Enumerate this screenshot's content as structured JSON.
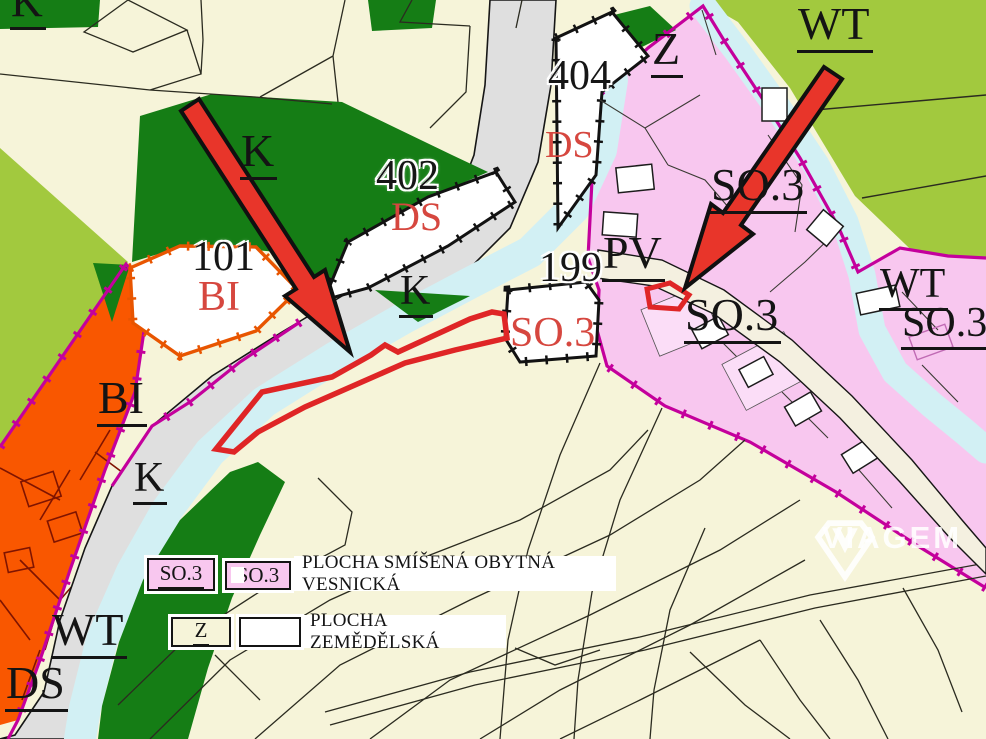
{
  "map": {
    "labels": [
      {
        "text": "K",
        "kind": "zone-clipped-top-left"
      },
      {
        "text": "K",
        "kind": "zone-landscape-green"
      },
      {
        "text": "402",
        "kind": "parcel-number"
      },
      {
        "text": "DS",
        "kind": "zone-road-proposed"
      },
      {
        "text": "404",
        "kind": "parcel-number"
      },
      {
        "text": "DS",
        "kind": "zone-road-proposed"
      },
      {
        "text": "Z",
        "kind": "zone-agricultural"
      },
      {
        "text": "WT",
        "kind": "zone-water"
      },
      {
        "text": "101",
        "kind": "parcel-number"
      },
      {
        "text": "BI",
        "kind": "zone-housing-proposed"
      },
      {
        "text": "K",
        "kind": "zone-landscape-green"
      },
      {
        "text": "199",
        "kind": "parcel-number"
      },
      {
        "text": "PV",
        "kind": "zone-public-space"
      },
      {
        "text": "SO.3",
        "kind": "zone-mixed-residential"
      },
      {
        "text": "SO.3",
        "kind": "zone-mixed-residential-proposed"
      },
      {
        "text": "SO.3",
        "kind": "zone-mixed-residential"
      },
      {
        "text": "WT",
        "kind": "zone-water"
      },
      {
        "text": "SO.3",
        "kind": "zone-mixed-residential"
      },
      {
        "text": "BI",
        "kind": "zone-housing"
      },
      {
        "text": "K",
        "kind": "zone-landscape-green"
      },
      {
        "text": "WT",
        "kind": "zone-water"
      },
      {
        "text": "DS",
        "kind": "zone-road"
      }
    ]
  },
  "legend": {
    "row1": {
      "box1_label": "SO.3",
      "box2_label": "SO.3",
      "description": "PLOCHA SMÍŠENÁ OBYTNÁ VESNICKÁ"
    },
    "row2": {
      "box1_label": "Z",
      "description": "PLOCHA ZEMĚDĚLSKÁ"
    }
  },
  "watermark": {
    "brand": "VIAGEM"
  },
  "colors": {
    "background_cream": "#F6F4D9",
    "light_green": "#A2C93E",
    "dark_green": "#157D15",
    "orange_zone": "#F95700",
    "pink_zone": "#F8C7EF",
    "magenta_border": "#C4009C",
    "water_cyan": "#D2F0F4",
    "road_gray": "#DFDFDF",
    "highlight_red": "#DF2526",
    "label_red": "#D6473F"
  }
}
